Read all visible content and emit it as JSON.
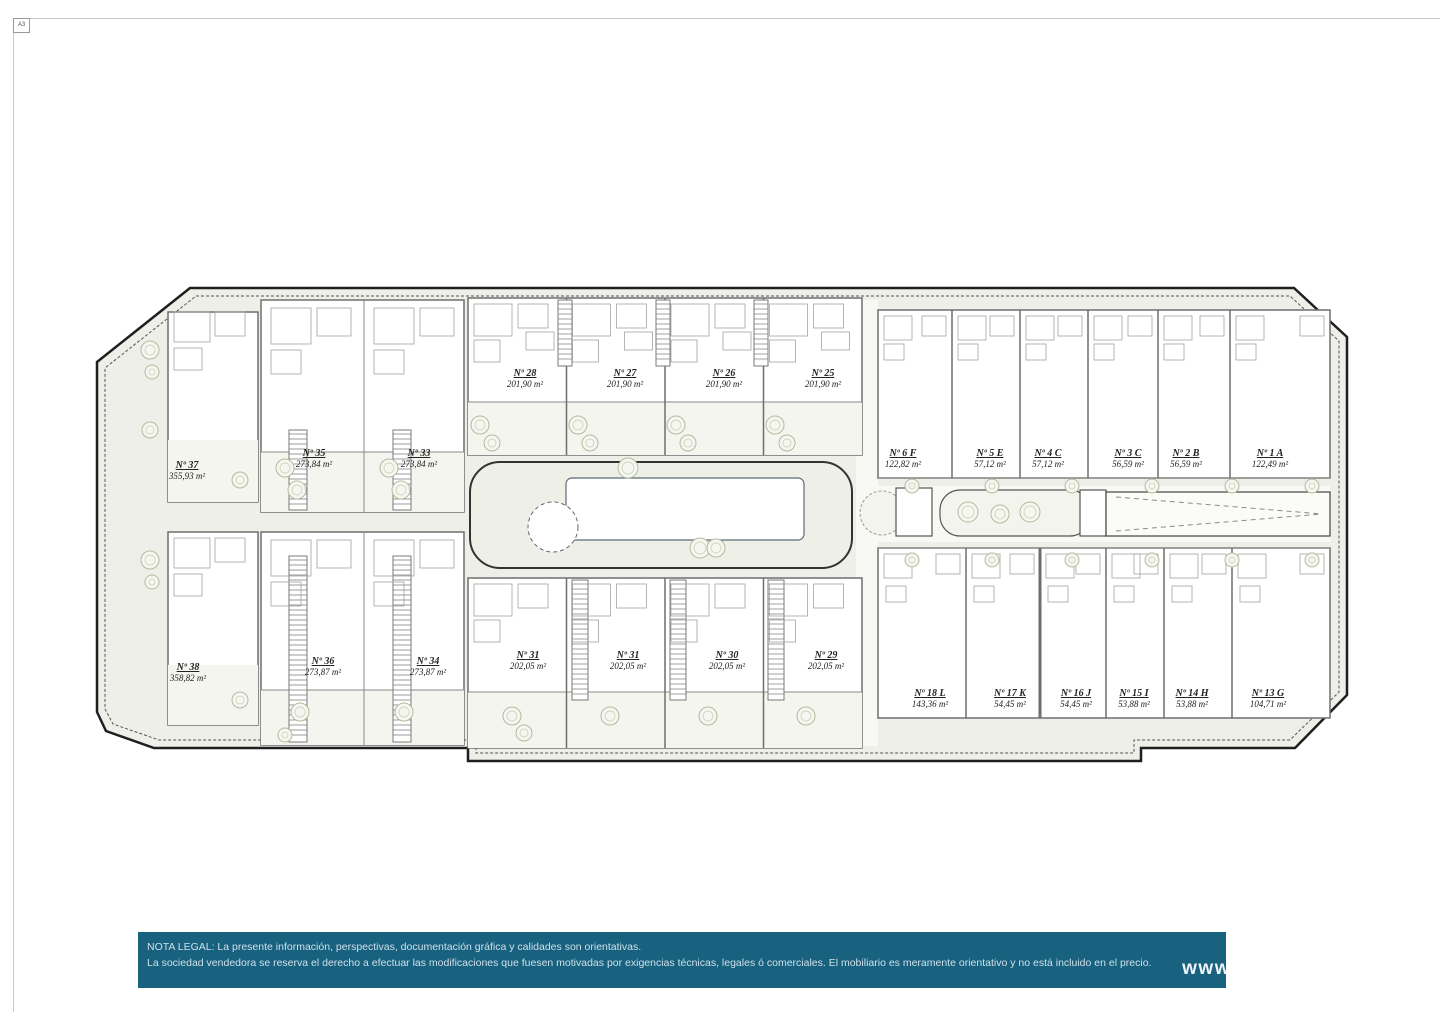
{
  "page": {
    "sheet_label": "A3"
  },
  "site_plan": {
    "units": [
      {
        "id": "37",
        "label": "Nº 37",
        "area": "355,93 m²",
        "x": 187,
        "y": 461
      },
      {
        "id": "35",
        "label": "Nº 35",
        "area": "273,84 m²",
        "x": 314,
        "y": 449
      },
      {
        "id": "33",
        "label": "Nº 33",
        "area": "273,84 m²",
        "x": 419,
        "y": 449
      },
      {
        "id": "38",
        "label": "Nº 38",
        "area": "358,82 m²",
        "x": 188,
        "y": 663
      },
      {
        "id": "36",
        "label": "Nº 36",
        "area": "273,87 m²",
        "x": 323,
        "y": 657
      },
      {
        "id": "34",
        "label": "Nº 34",
        "area": "273,87 m²",
        "x": 428,
        "y": 657
      },
      {
        "id": "28",
        "label": "Nº 28",
        "area": "201,90 m²",
        "x": 525,
        "y": 369
      },
      {
        "id": "27",
        "label": "Nº 27",
        "area": "201,90 m²",
        "x": 625,
        "y": 369
      },
      {
        "id": "26",
        "label": "Nº 26",
        "area": "201,90 m²",
        "x": 724,
        "y": 369
      },
      {
        "id": "25",
        "label": "Nº 25",
        "area": "201,90 m²",
        "x": 823,
        "y": 369
      },
      {
        "id": "31L",
        "label": "Nº 31",
        "area": "202,05 m²",
        "x": 528,
        "y": 651
      },
      {
        "id": "31R",
        "label": "Nº 31",
        "area": "202,05 m²",
        "x": 628,
        "y": 651
      },
      {
        "id": "30",
        "label": "Nº 30",
        "area": "202,05 m²",
        "x": 727,
        "y": 651
      },
      {
        "id": "29",
        "label": "Nº 29",
        "area": "202,05 m²",
        "x": 826,
        "y": 651
      },
      {
        "id": "6F",
        "label": "Nº 6 F",
        "area": "122,82 m²",
        "x": 903,
        "y": 449
      },
      {
        "id": "5E",
        "label": "Nº 5 E",
        "area": "57,12 m²",
        "x": 990,
        "y": 449
      },
      {
        "id": "4C",
        "label": "Nº 4 C",
        "area": "57,12 m²",
        "x": 1048,
        "y": 449
      },
      {
        "id": "3C",
        "label": "Nº 3 C",
        "area": "56,59 m²",
        "x": 1128,
        "y": 449
      },
      {
        "id": "2B",
        "label": "Nº 2 B",
        "area": "56,59 m²",
        "x": 1186,
        "y": 449
      },
      {
        "id": "1A",
        "label": "Nº 1 A",
        "area": "122,49 m²",
        "x": 1270,
        "y": 449
      },
      {
        "id": "18L",
        "label": "Nº 18 L",
        "area": "143,36 m²",
        "x": 930,
        "y": 689
      },
      {
        "id": "17K",
        "label": "Nº 17 K",
        "area": "54,45 m²",
        "x": 1010,
        "y": 689
      },
      {
        "id": "16J",
        "label": "Nº 16 J",
        "area": "54,45 m²",
        "x": 1076,
        "y": 689
      },
      {
        "id": "15I",
        "label": "Nº 15 I",
        "area": "53,88 m²",
        "x": 1134,
        "y": 689
      },
      {
        "id": "14H",
        "label": "Nº 14 H",
        "area": "53,88 m²",
        "x": 1192,
        "y": 689
      },
      {
        "id": "13G",
        "label": "Nº 13 G",
        "area": "104,71 m²",
        "x": 1268,
        "y": 689
      }
    ]
  },
  "footer": {
    "line1": "NOTA LEGAL: La presente información, perspectivas, documentación gráfica y calidades son orientativas.",
    "line2": "La sociedad vendedora se reserva el derecho a efectuar las modificaciones que fuesen motivadas por exigencias técnicas, legales ó comerciales. El mobiliario es meramente orientativo y no está incluido en el precio.",
    "website_text": "www",
    "bar_color": "#18617f"
  }
}
